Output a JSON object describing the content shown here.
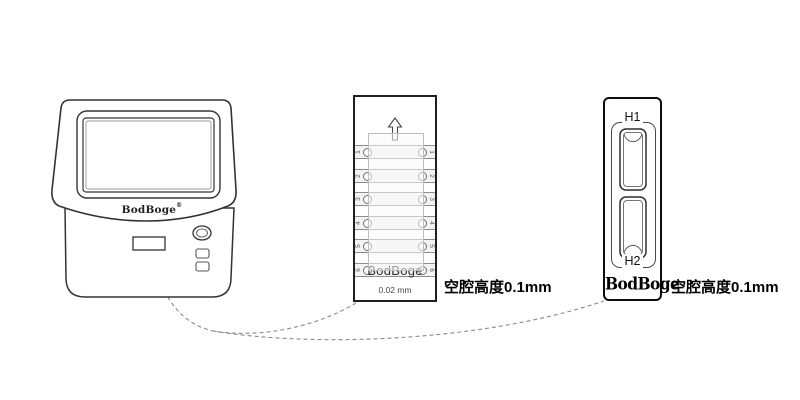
{
  "device": {
    "brand": "BodBoge",
    "brand_mark": "®"
  },
  "middle_slide": {
    "channels": [
      "1",
      "2",
      "3",
      "4",
      "5",
      "6"
    ],
    "brand": "BodBoge",
    "thickness_label": "0.02 mm",
    "caption": "空腔高度0.1mm"
  },
  "right_slide": {
    "well_top_label": "H1",
    "well_bottom_label": "H2",
    "brand": "BodBoge",
    "caption": "空腔高度0.1mm"
  },
  "colors": {
    "line_art": "#333333",
    "dashed_connector": "#8a8a8a",
    "channel_fill": "#f3f3f3"
  }
}
